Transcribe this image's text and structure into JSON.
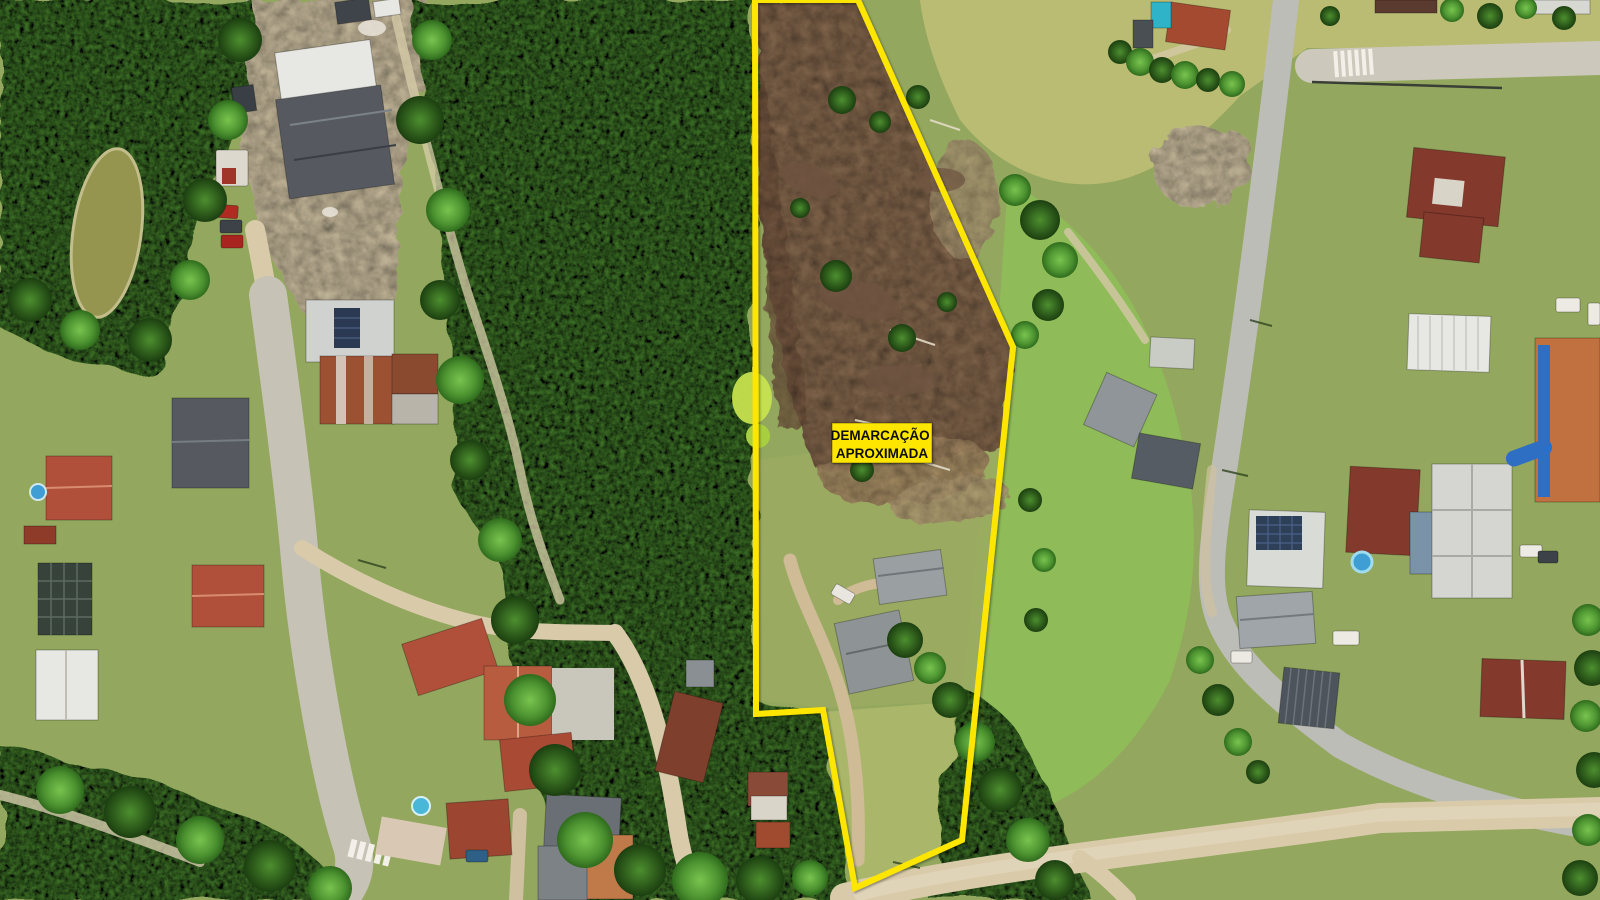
{
  "annotation": {
    "label": {
      "line1": "DEMARCAÇÃO",
      "line2": "APROXIMADA",
      "bg_color": "#ffe600",
      "text_color": "#111111",
      "x": 832,
      "y": 423,
      "width": 100,
      "height": 40,
      "cx": 882,
      "line1_y": 440,
      "line2_y": 458
    },
    "polygon": {
      "points": "755,0 858,0 1013,347 962,840 855,888 823,710 756,714",
      "stroke_color": "#ffe600",
      "stroke_width": 6
    }
  },
  "scene": {
    "type": "aerial-drone-photo",
    "features": [
      "dense forest band",
      "cleared brown land parcel outlined in yellow",
      "grass fields",
      "concrete streets with crosswalks",
      "sandy dirt roads",
      "houses with red tile roofs",
      "industrial warehouses",
      "small pond",
      "parked cars",
      "sheds inside parcel"
    ]
  },
  "palette": {
    "grass": "#93a75e",
    "grass_bright": "#8fbb59",
    "grass_pale": "#b9bc72",
    "forest_green": "#4f9230",
    "dirt_brown": "#8f6f52",
    "sand": "#d9cbaa",
    "road_concrete": "#c6c2b6",
    "road_asphalt": "#bdbdb8",
    "roof_red": "#b0503a",
    "roof_rust": "#9c5232",
    "roof_maroon": "#83392c",
    "roof_orange": "#c1703f",
    "roof_gray": "#565a60",
    "roof_white": "#e7e7e3",
    "pond_olive": "#96954f",
    "pool_blue": "#3f9fd4",
    "label_text": "#111111"
  }
}
